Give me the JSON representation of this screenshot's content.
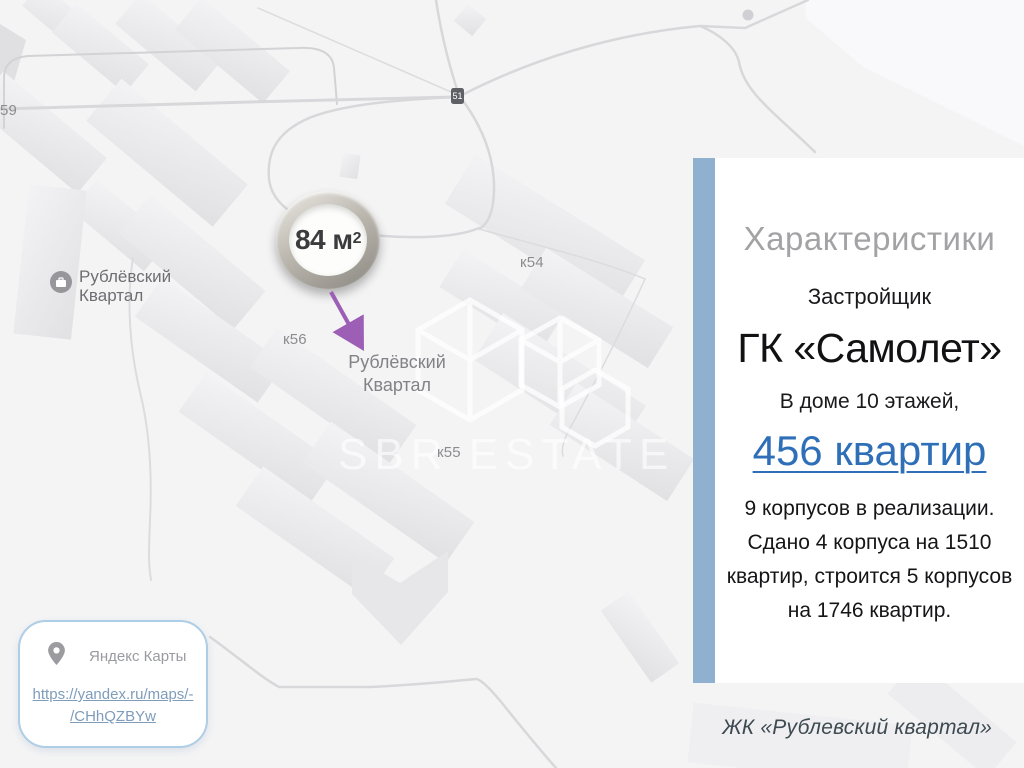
{
  "colors": {
    "accent_bar": "#8fb1cf",
    "link_blue": "#2e6fb8",
    "arrow_purple": "#9c5fb5",
    "card_border": "#aecde6",
    "url_link": "#7f9cba",
    "map_label": "#8c8c90"
  },
  "map": {
    "watermark_brand": "SBR ESTATE",
    "marker": {
      "area_value": "84 м",
      "area_sup": "2"
    },
    "road_badge": "51",
    "labels": {
      "building_59": "59",
      "place_left_line1": "Рублёвский",
      "place_left_line2": "Квартал",
      "k56": "к56",
      "k54": "к54",
      "k55": "к55",
      "place_center_line1": "Рублёвский",
      "place_center_line2": "Квартал"
    }
  },
  "panel": {
    "title": "Характеристики",
    "developer_label": "Застройщик",
    "developer_name": "ГК «Самолет»",
    "floors_line": "В доме 10 этажей,",
    "apartments_link": "456 квартир",
    "description_lines": {
      "0": "9 корпусов в реализации.",
      "1": "Сдано 4 корпуса на 1510",
      "2": "квартир, строится 5 корпусов",
      "3": "на 1746 квартир."
    }
  },
  "caption": {
    "complex_name": "ЖК «Рублевский квартал»"
  },
  "source_card": {
    "provider": "Яндекс Карты",
    "url_line1": "https://yandex.ru/maps/-",
    "url_line2": "/CHhQZBYw"
  }
}
